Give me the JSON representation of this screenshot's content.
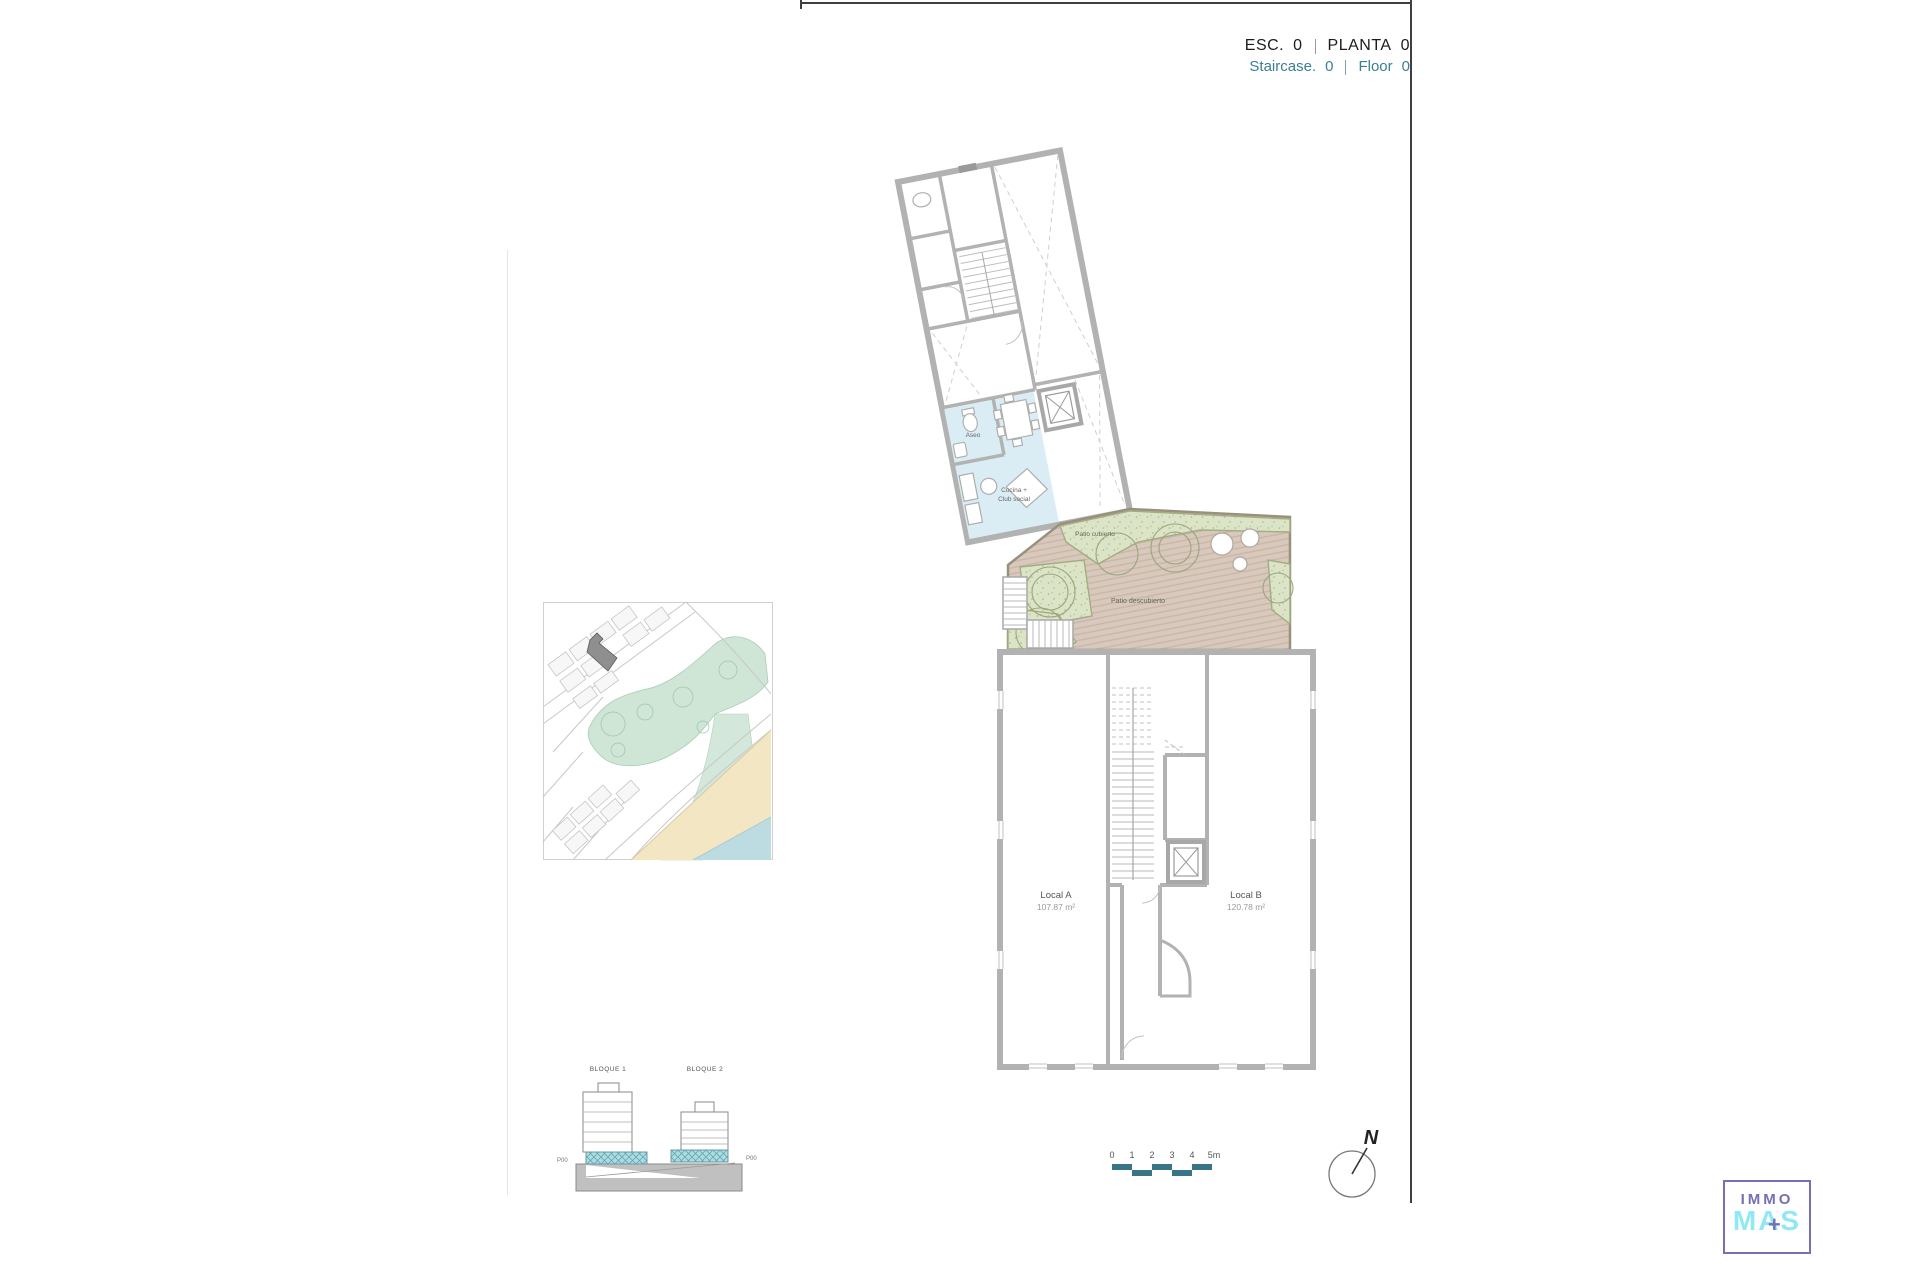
{
  "header": {
    "esc_label": "ESC.",
    "esc_value": "0",
    "planta_label": "PLANTA",
    "planta_value": "0",
    "staircase_label": "Staircase.",
    "staircase_value": "0",
    "floor_label": "Floor",
    "floor_value": "0"
  },
  "floor_plan": {
    "labels": {
      "aseo": "Aseo",
      "cocina_line1": "Cocina +",
      "cocina_line2": "Club social",
      "patio_cubierto": "Patio cubierto",
      "patio_descubierto": "Patio descubierto",
      "local_a_name": "Local A",
      "local_a_area": "107.87 m²",
      "local_b_name": "Local B",
      "local_b_area": "120.78 m²"
    }
  },
  "elevation": {
    "bloque1_label": "BLOQUE 1",
    "bloque2_label": "BLOQUE 2",
    "p00_left": "P00",
    "p00_right": "P00"
  },
  "scale_bar": {
    "ticks": [
      "0",
      "1",
      "2",
      "3",
      "4",
      "5m"
    ]
  },
  "north_arrow": {
    "label": "N"
  },
  "logo": {
    "line1": "IMMO",
    "line2": "MAS",
    "plus_symbol": "+"
  },
  "colors": {
    "teal_text": "#3a7f93",
    "scale_teal": "#3a7487",
    "wall_gray": "#b2b2b2",
    "room_blue": "#daedf4",
    "patio_tan": "#d8c9bc",
    "garden_green": "#dbe4c6",
    "map_green": "#cfe5d6",
    "map_sand": "#f3e6c3",
    "map_water": "#bddce2",
    "highlight_building": "#8f8f8f",
    "elevation_teal": "#acdbe0",
    "logo_purple": "#7570b3",
    "logo_cyan": "#8fe9f5"
  }
}
